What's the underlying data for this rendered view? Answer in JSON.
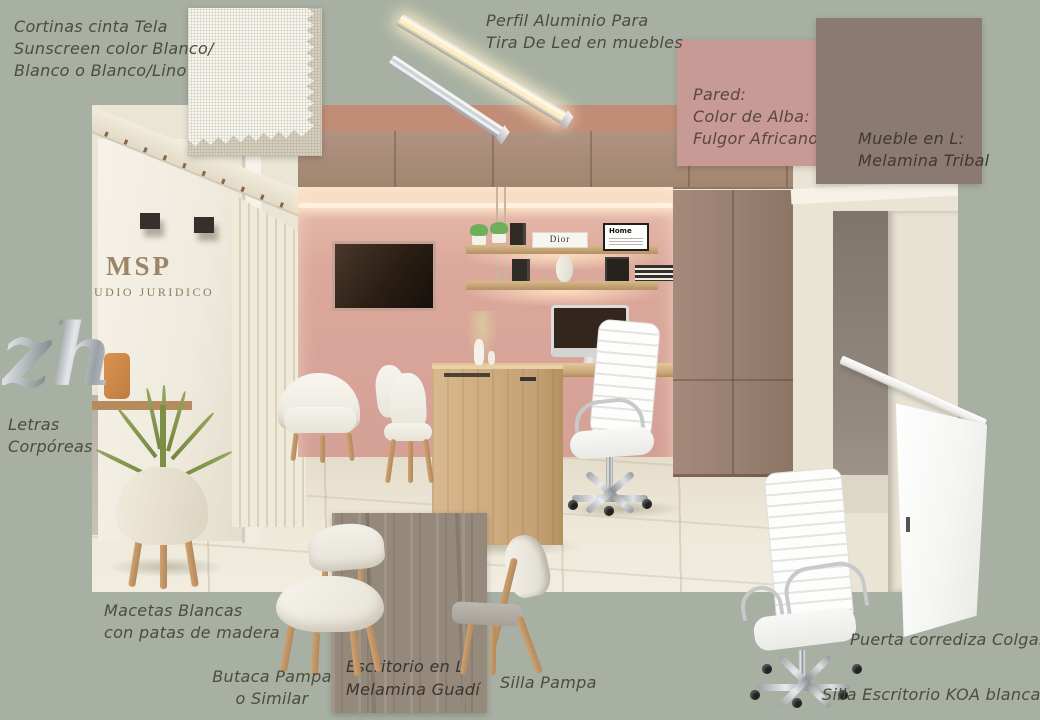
{
  "colors": {
    "background": "#a7b0a2",
    "wall_paint_fulgor_africano": "#c89a95",
    "melamina_tribal": "#8a7a72",
    "melamina_guadi": "#95897b",
    "desk_wood": "#cfae82",
    "render_pink_wall": "#d8a89c"
  },
  "annotations": {
    "cortinas": [
      "Cortinas cinta Tela",
      "Sunscreen color Blanco/",
      "Blanco o Blanco/Lino"
    ],
    "perfil": [
      "Perfil Aluminio Para",
      "Tira De Led en muebles"
    ],
    "pared": [
      "Pared:",
      "Color de Alba:",
      "Fulgor Africano"
    ],
    "mueble": [
      "Mueble en L:",
      "Melamina Tribal"
    ],
    "letras": [
      "Letras",
      "Corpóreas"
    ],
    "macetas": [
      "Macetas Blancas",
      "con patas de madera"
    ],
    "butaca": [
      "Butaca Pampa",
      "o Similar"
    ],
    "escritorio": [
      "Escritorio en L",
      "Melamina Guadí"
    ],
    "silla_pampa": "Silla Pampa",
    "puerta": "Puerta corrediza Colgante",
    "silla_koa": "Silla Escritorio KOA blanca"
  },
  "letters": {
    "glyph": "zh"
  },
  "render_content": {
    "sign_top": "MSP",
    "sign_bottom": "UDIO JURIDICO",
    "shelf_poster": "Home",
    "shelf_book": "Dior"
  }
}
